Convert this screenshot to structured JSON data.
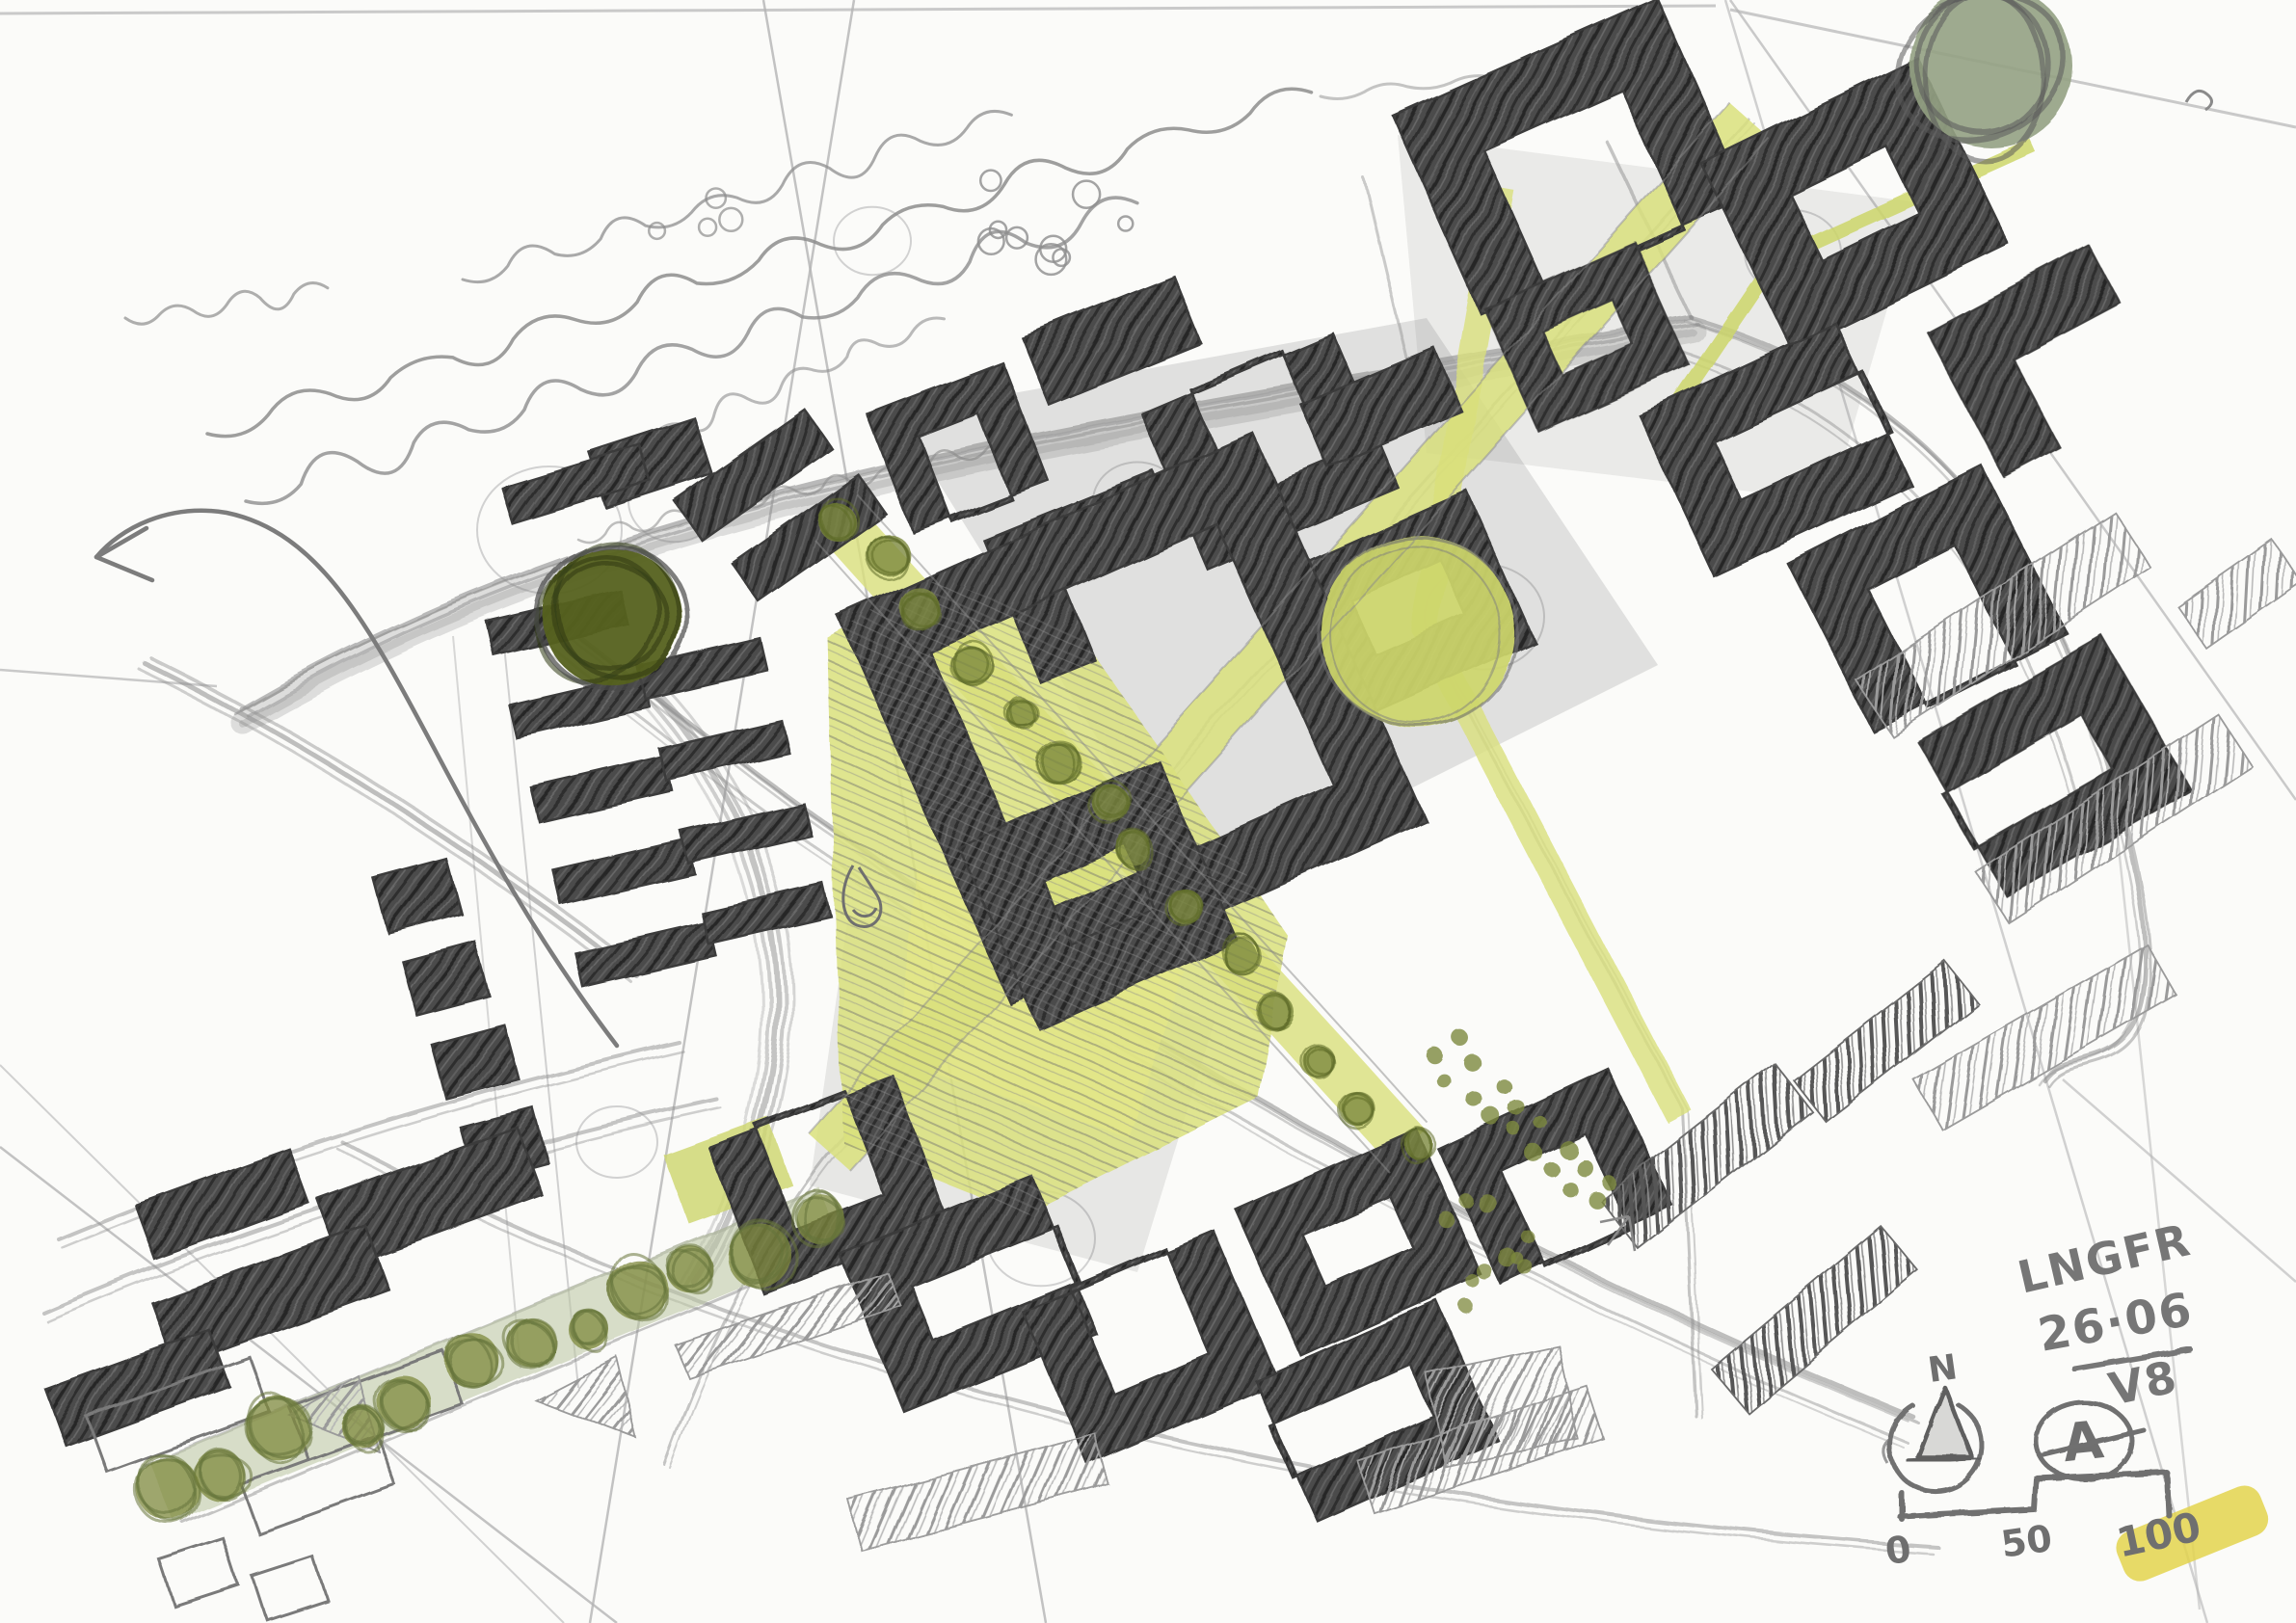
{
  "sketch": {
    "annotations": {
      "project_code": "LNGFR",
      "date": "26·06",
      "version": "V8"
    },
    "north_indicator": {
      "label": "N"
    },
    "author_mark": {
      "label": "A"
    },
    "scale_bar": {
      "tick_labels": [
        "0",
        "50",
        "100"
      ]
    },
    "colors": {
      "paper": "#fbfbf9",
      "pencil_light": "#b5b5b5",
      "pencil": "#8d8d8d",
      "pencil_dark": "#6f6f6f",
      "graphite_block": "#4c4c4c",
      "highlighter": "#d9e07c",
      "highlighter_deep": "#cdd66a",
      "highlighter_bright": "#e6ea85",
      "marker_olive": "#7d8a3f",
      "marker_olive_dark": "#5f6b2a",
      "marker_dark_green": "#55611f",
      "marker_sage": "#b9c4a0",
      "tree_sage": "#93a183",
      "swatch_yellow": "#e3d44e"
    }
  }
}
